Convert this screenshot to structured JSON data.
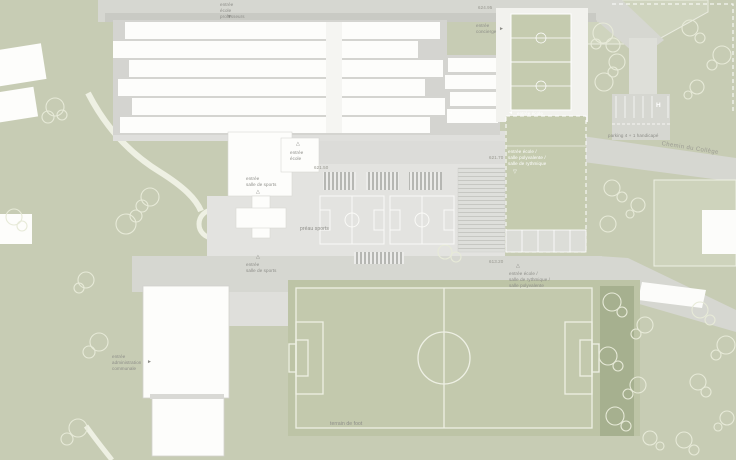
{
  "plan_type": "architectural site plan (school campus)",
  "labels": {
    "teachers_entrance": "entrée\nécole\nprofesseurs",
    "caretaker_entrance": "entrée\nconcierge",
    "school_entrance": "entrée\nécole",
    "sports_hall_entrance_north": "entrée\nsalle de sports",
    "sports_courtyard": "préau sports",
    "court_school_entrance": "entrée école",
    "court_entrance_multi": "entrée école /\nsalle polyvalente /\nsalle de rythmique",
    "parking": "parking 4 + 1 handicapé",
    "handicap_stall": "H",
    "street_name": "Chemin du Collège",
    "sports_hall_entrance_south": "entrée\nsalle de sports",
    "road_entrance_multi": "entrée école /\nsalle de rythmique /\nsalle polyvalente",
    "administration_entrance": "entrée\nadministration\ncommunale",
    "football_pitch": "terrain de foot"
  },
  "levels": {
    "yard": "621.50",
    "court": "621.70",
    "road": "613.20",
    "parking_area": "624.95"
  },
  "icons": {
    "arrow_down_filled": "▼",
    "arrow_right_filled": "►",
    "arrow_left_filled": "◄",
    "arrow_up_outline": "△",
    "arrow_down_outline": "▽"
  },
  "colors": {
    "background_green": "#c7ccb4",
    "road_gray": "#d6d7d1",
    "yard_gray": "#e3e3e0",
    "court_green": "#c5cbaf",
    "building_white": "#fdfdfb",
    "hedge_olive": "#a6b08f",
    "label_gray": "#8d8d88",
    "line_white": "#ffffff"
  }
}
